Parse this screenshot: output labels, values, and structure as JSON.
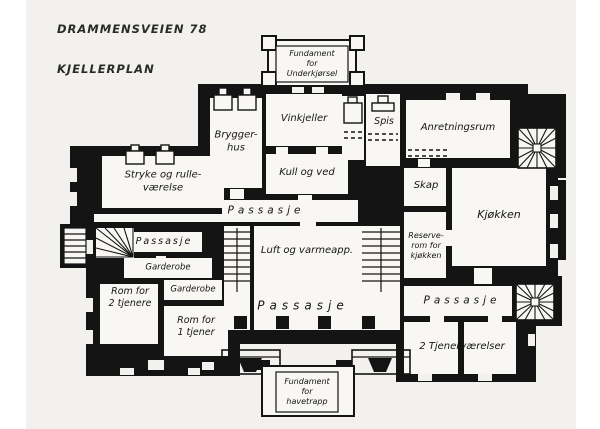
{
  "page": {
    "title": "DRAMMENSVEIEN 78",
    "subtitle": "KJELLERPLAN"
  },
  "annotations": {
    "fundament_top": "Fundament\nfor\nUnderkjørsel",
    "fundament_bottom": "Fundament\nfor\nhavetrapp"
  },
  "rooms": {
    "bryggerhus": "Brygger-\nhus",
    "vinkjeller": "Vinkjeller",
    "kull_og_ved": "Kull og ved",
    "spis": "Spis",
    "anretningsrum": "Anretningsrum",
    "skap": "Skap",
    "kjokken": "Kjøkken",
    "reserverom": "Reserve-\nrom for\nkjøkken",
    "stryke_og_rulle": "Stryke og rulle-\nværelse",
    "passasje_nord": "Passasje",
    "passasje_vest": "Passasje",
    "garderobe_ovre": "Garderobe",
    "garderobe_nedre": "Garderobe",
    "rom_for_2_tjenere": "Rom for\n2 tjenere",
    "rom_for_1_tjener": "Rom for\n1 tjener",
    "luft_og_varme": "Luft og varmeapp.",
    "passasje_sentrum": "Passasje",
    "passasje_ost": "Passasje",
    "tjenervaerelser": "2 Tjenerværelser"
  },
  "colors": {
    "ink": "#141414",
    "paper": "#f2f1ed",
    "room_fill": "#f8f7f4",
    "margin": "#ffffff"
  }
}
